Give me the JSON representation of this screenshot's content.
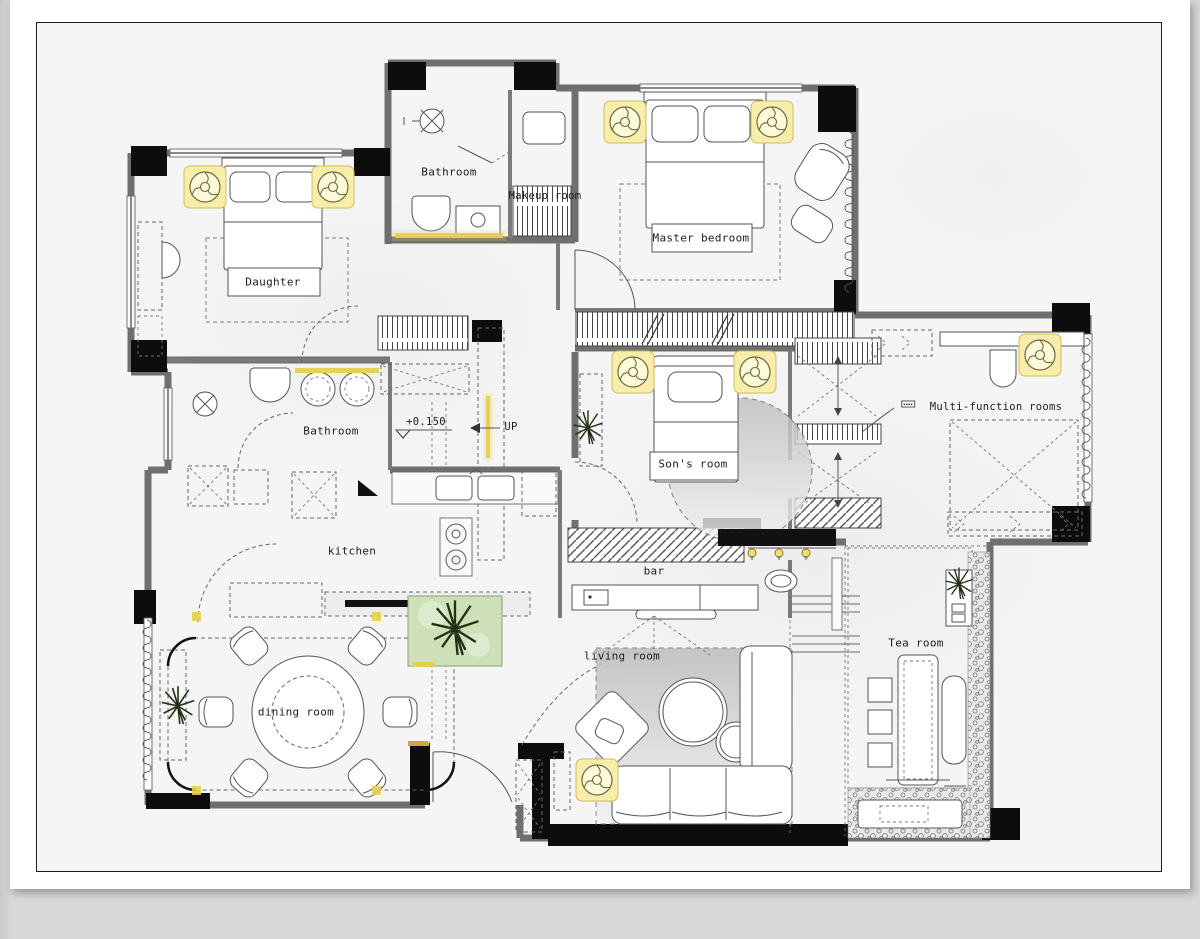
{
  "page": {
    "background_color": "#d8d8d8",
    "card_color": "#ffffff",
    "plan_background": "#f5f5f6",
    "border_color": "#1b1b1b"
  },
  "floorplan": {
    "rooms": [
      {
        "id": "bathroom-top",
        "label": "Bathroom"
      },
      {
        "id": "makeup-room",
        "label": "Makeup room"
      },
      {
        "id": "master-bedroom",
        "label": "Master bedroom"
      },
      {
        "id": "daughter-room",
        "label": "Daughter"
      },
      {
        "id": "bathroom-main",
        "label": "Bathroom"
      },
      {
        "id": "sons-room",
        "label": "Son's room"
      },
      {
        "id": "multi-function",
        "label": "Multi-function rooms"
      },
      {
        "id": "kitchen",
        "label": "kitchen"
      },
      {
        "id": "bar",
        "label": "bar"
      },
      {
        "id": "dining-room",
        "label": "dining room"
      },
      {
        "id": "living-room",
        "label": "living room"
      },
      {
        "id": "tea-room",
        "label": "Tea room"
      }
    ],
    "annotations": [
      {
        "id": "floor-elevation",
        "label": "+0.150"
      },
      {
        "id": "stair-direction",
        "label": "UP"
      },
      {
        "id": "tiny-note",
        "label": "▪▪▪▪"
      }
    ],
    "symbols": {
      "ceiling_fan_light": 8,
      "pendant_bulb": 3,
      "shower_head": 2,
      "plant": 4,
      "courtyard_tree": 1
    },
    "colors": {
      "wall_gray": "#6f6f6f",
      "structure_black": "#0d0d0d",
      "light_accent_yellow": "#e6cf4e",
      "fan_fill_yellow": "#f8edaa",
      "courtyard_green": "#cfe0b8"
    }
  }
}
